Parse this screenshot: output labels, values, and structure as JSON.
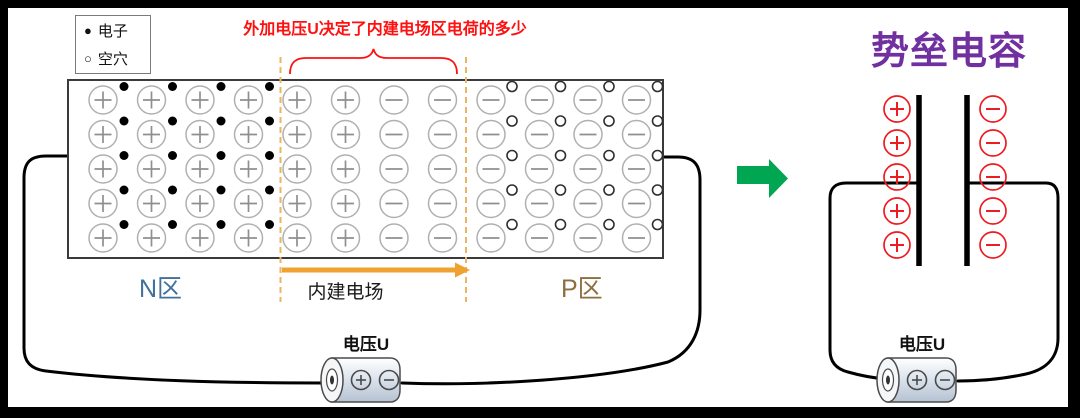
{
  "colors": {
    "caption_red": "#FF1010",
    "charge_red": "#ED1C24",
    "arrow_orange": "#F0A230",
    "dashed_orange": "#EBB563",
    "green_arrow": "#00A651",
    "purple_title": "#7030A0",
    "n_label_blue": "#41719C",
    "p_label_brown": "#8D6E3F",
    "ion_stroke_gray": "#B0B0B0",
    "ion_sign_gray": "#8F8F8F",
    "wire_black": "#000000"
  },
  "legend": {
    "electron_symbol": "●",
    "electron_label": "电子",
    "hole_symbol": "○",
    "hole_label": "空穴"
  },
  "caption": "外加电压U决定了内建电场区电荷的多少",
  "junction": {
    "rows": 5,
    "columns": [
      {
        "ion": "+",
        "carrier": "electron"
      },
      {
        "ion": "+",
        "carrier": "electron"
      },
      {
        "ion": "+",
        "carrier": "electron"
      },
      {
        "ion": "+",
        "carrier": "electron"
      },
      {
        "ion": "+",
        "carrier": "none"
      },
      {
        "ion": "+",
        "carrier": "none"
      },
      {
        "ion": "-",
        "carrier": "none"
      },
      {
        "ion": "-",
        "carrier": "none"
      },
      {
        "ion": "-",
        "carrier": "hole"
      },
      {
        "ion": "-",
        "carrier": "hole"
      },
      {
        "ion": "-",
        "carrier": "hole"
      },
      {
        "ion": "-",
        "carrier": "hole"
      }
    ],
    "n_region_label": "N区",
    "field_label": "内建电场",
    "p_region_label": "P区"
  },
  "source_battery": {
    "label": "电压U"
  },
  "capacitor": {
    "title": "势垒电容",
    "positive_charges": 5,
    "negative_charges": 5,
    "battery_label": "电压U"
  }
}
